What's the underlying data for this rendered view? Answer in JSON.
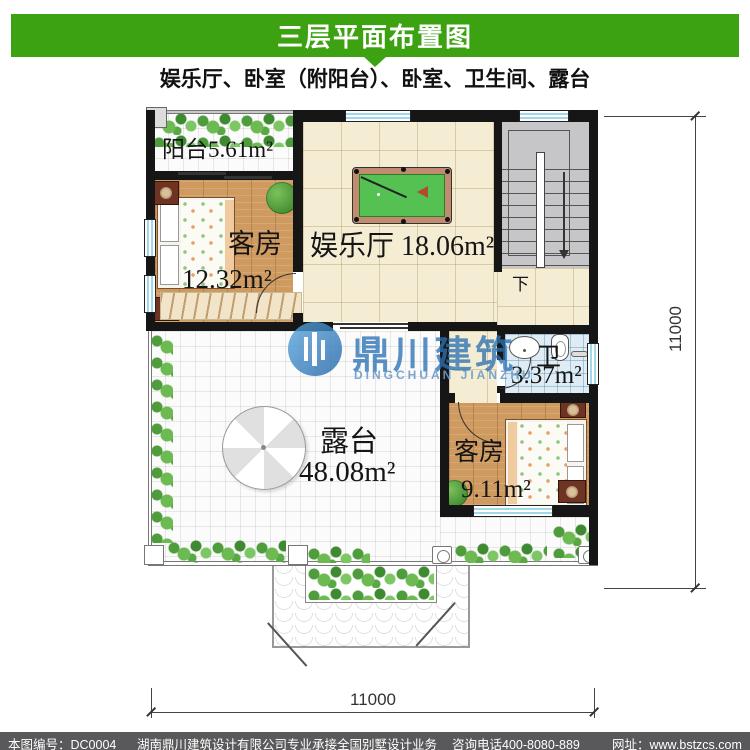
{
  "header": {
    "title": "三层平面布置图",
    "subtitle": "娱乐厅、卧室（附阳台）、卧室、卫生间、露台"
  },
  "plan": {
    "rooms": {
      "balcony": {
        "label": "阳台5.61m²"
      },
      "guest1": {
        "name": "客房",
        "area": "12.32m²"
      },
      "hall": {
        "name": "娱乐厅",
        "area": "18.06m²"
      },
      "bath": {
        "name": "卫",
        "area": "3.37m²"
      },
      "guest2": {
        "name": "客房",
        "area": "9.11m²"
      },
      "terrace": {
        "name": "露台",
        "area": "48.08m²"
      }
    },
    "stairs": {
      "down_label": "下"
    },
    "dimensions": {
      "right": "11000",
      "bottom": "11000"
    }
  },
  "watermark": {
    "cn": "鼎川建筑",
    "en": "DINGCHUAN JIANZHU"
  },
  "footer": {
    "code": "本图编号：DC0004",
    "company": "湖南鼎川建筑设计有限公司专业承接全国别墅设计业务",
    "phone": "咨询电话400-8080-889",
    "website": "网址：www.bstzcs.com"
  },
  "colors": {
    "header_green": "#3DA212",
    "footer_gray": "#59595B",
    "wall_black": "#161616",
    "pool_table_green": "#55C152",
    "pool_table_rim": "#C08B6E",
    "watermark_blue": "#2C72B4",
    "window_blue": "#9FD8EA"
  }
}
